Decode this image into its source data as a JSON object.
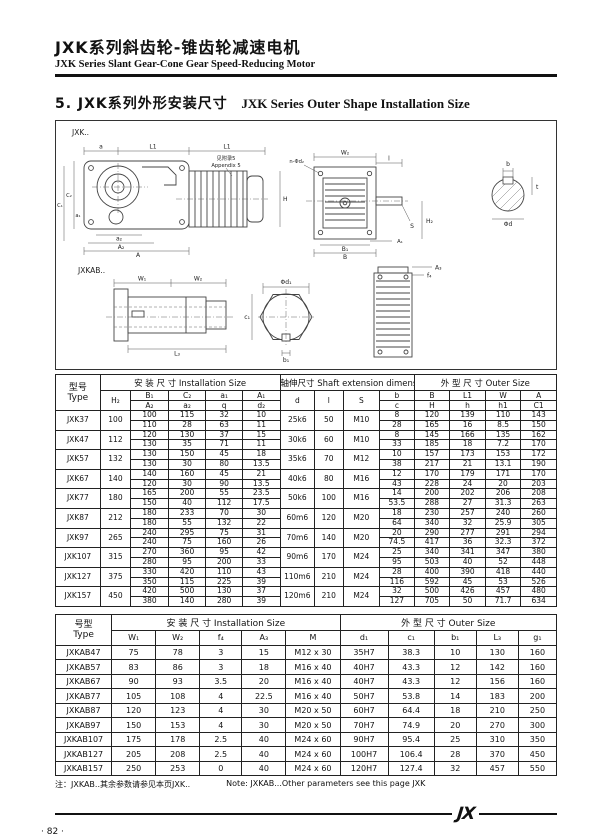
{
  "header": {
    "title_cn": "JXK系列斜齿轮-锥齿轮减速电机",
    "title_en": "JXK Series Slant Gear-Cone Gear Speed-Reducing Motor"
  },
  "section": {
    "title_cn": "5. JXK系列外形安装尺寸",
    "title_en": "JXK Series Outer Shape Installation Size"
  },
  "drawing": {
    "label_jxk": "JXK..",
    "label_jxkab": "JXKAB..",
    "appendix_cn": "见附录5",
    "appendix_en": "Appendix 5",
    "dims": [
      "a",
      "L1",
      "L1",
      "C₁",
      "C₂",
      "a₂",
      "A₂",
      "A",
      "a₁",
      "H",
      "W₂",
      "l",
      "S",
      "n-Φd₂",
      "B₁",
      "B",
      "A₁",
      "b",
      "t",
      "Φd",
      "W₁",
      "W₂",
      "L₃",
      "Φd₁",
      "c₁",
      "b₁",
      "A₃",
      "f₄",
      "H₂"
    ]
  },
  "table1": {
    "type_header": [
      "型号",
      "Type"
    ],
    "groups": [
      {
        "label": "安 装 尺 寸 Installation Size",
        "span": 5
      },
      {
        "label": "轴伸尺寸 Shaft extension dimension",
        "span": 4
      },
      {
        "label": "外 型 尺 寸 Outer Size",
        "span": 4
      }
    ],
    "sub_headers": [
      "H₂",
      [
        "B₁",
        "A₂"
      ],
      [
        "C₂",
        "a₂"
      ],
      [
        "a₁",
        "q"
      ],
      [
        "A₁",
        "d₂"
      ],
      "d",
      "l",
      "S",
      [
        "b",
        "c"
      ],
      [
        "B",
        "H"
      ],
      [
        "L1",
        "h"
      ],
      [
        "W",
        "h1"
      ],
      [
        "A",
        "C1"
      ]
    ],
    "rows": [
      {
        "type": "JXK37",
        "cells": [
          "100",
          [
            "100",
            "110"
          ],
          [
            "115",
            "28"
          ],
          [
            "32",
            "63"
          ],
          [
            "10",
            "11"
          ],
          "25k6",
          "50",
          "M10",
          [
            "8",
            "28"
          ],
          [
            "120",
            "165"
          ],
          [
            "139",
            "16"
          ],
          [
            "110",
            "8.5"
          ],
          [
            "143",
            "150"
          ]
        ]
      },
      {
        "type": "JXK47",
        "cells": [
          "112",
          [
            "120",
            "130"
          ],
          [
            "130",
            "35"
          ],
          [
            "37",
            "71"
          ],
          [
            "15",
            "11"
          ],
          "30k6",
          "60",
          "M10",
          [
            "8",
            "33"
          ],
          [
            "145",
            "185"
          ],
          [
            "166",
            "18"
          ],
          [
            "135",
            "7.2"
          ],
          [
            "162",
            "170"
          ]
        ]
      },
      {
        "type": "JXK57",
        "cells": [
          "132",
          [
            "130",
            "130"
          ],
          [
            "150",
            "30"
          ],
          [
            "45",
            "80"
          ],
          [
            "18",
            "13.5"
          ],
          "35k6",
          "70",
          "M12",
          [
            "10",
            "38"
          ],
          [
            "157",
            "217"
          ],
          [
            "173",
            "21"
          ],
          [
            "153",
            "13.1"
          ],
          [
            "172",
            "190"
          ]
        ]
      },
      {
        "type": "JXK67",
        "cells": [
          "140",
          [
            "140",
            "120"
          ],
          [
            "160",
            "30"
          ],
          [
            "45",
            "90"
          ],
          [
            "21",
            "13.5"
          ],
          "40k6",
          "80",
          "M16",
          [
            "12",
            "43"
          ],
          [
            "170",
            "228"
          ],
          [
            "179",
            "24"
          ],
          [
            "171",
            "20"
          ],
          [
            "170",
            "203"
          ]
        ]
      },
      {
        "type": "JXK77",
        "cells": [
          "180",
          [
            "165",
            "150"
          ],
          [
            "200",
            "40"
          ],
          [
            "55",
            "112"
          ],
          [
            "23.5",
            "17.5"
          ],
          "50k6",
          "100",
          "M16",
          [
            "14",
            "53.5"
          ],
          [
            "200",
            "288"
          ],
          [
            "202",
            "27"
          ],
          [
            "206",
            "31.3"
          ],
          [
            "208",
            "263"
          ]
        ]
      },
      {
        "type": "JXK87",
        "cells": [
          "212",
          [
            "180",
            "180"
          ],
          [
            "233",
            "55"
          ],
          [
            "70",
            "132"
          ],
          [
            "30",
            "22"
          ],
          "60m6",
          "120",
          "M20",
          [
            "18",
            "64"
          ],
          [
            "230",
            "340"
          ],
          [
            "257",
            "32"
          ],
          [
            "240",
            "25.9"
          ],
          [
            "260",
            "305"
          ]
        ]
      },
      {
        "type": "JXK97",
        "cells": [
          "265",
          [
            "240",
            "240"
          ],
          [
            "295",
            "75"
          ],
          [
            "75",
            "160"
          ],
          [
            "31",
            "26"
          ],
          "70m6",
          "140",
          "M20",
          [
            "20",
            "74.5"
          ],
          [
            "290",
            "417"
          ],
          [
            "277",
            "36"
          ],
          [
            "291",
            "32.3"
          ],
          [
            "294",
            "372"
          ]
        ]
      },
      {
        "type": "JXK107",
        "cells": [
          "315",
          [
            "270",
            "280"
          ],
          [
            "360",
            "95"
          ],
          [
            "95",
            "200"
          ],
          [
            "42",
            "33"
          ],
          "90m6",
          "170",
          "M24",
          [
            "25",
            "95"
          ],
          [
            "340",
            "503"
          ],
          [
            "341",
            "40"
          ],
          [
            "347",
            "52"
          ],
          [
            "380",
            "448"
          ]
        ]
      },
      {
        "type": "JXK127",
        "cells": [
          "375",
          [
            "330",
            "350"
          ],
          [
            "420",
            "115"
          ],
          [
            "110",
            "225"
          ],
          [
            "43",
            "39"
          ],
          "110m6",
          "210",
          "M24",
          [
            "28",
            "116"
          ],
          [
            "400",
            "592"
          ],
          [
            "390",
            "45"
          ],
          [
            "418",
            "53"
          ],
          [
            "440",
            "526"
          ]
        ]
      },
      {
        "type": "JXK157",
        "cells": [
          "450",
          [
            "420",
            "380"
          ],
          [
            "500",
            "140"
          ],
          [
            "130",
            "280"
          ],
          [
            "37",
            "39"
          ],
          "120m6",
          "210",
          "M24",
          [
            "32",
            "127"
          ],
          [
            "500",
            "705"
          ],
          [
            "426",
            "50"
          ],
          [
            "457",
            "71.7"
          ],
          [
            "480",
            "634"
          ]
        ]
      }
    ]
  },
  "table2": {
    "type_header": [
      "号型",
      "Type"
    ],
    "groups": [
      {
        "label": "安  装  尺  寸  Installation Size",
        "span": 5
      },
      {
        "label": "外  型  尺  寸  Outer Size",
        "span": 5
      }
    ],
    "sub_headers": [
      "W₁",
      "W₂",
      "f₄",
      "A₃",
      "M",
      "d₁",
      "c₁",
      "b₁",
      "L₃",
      "g₁"
    ],
    "rows": [
      {
        "type": "JXKAB47",
        "cells": [
          "75",
          "78",
          "3",
          "15",
          "M12 x 30",
          "35H7",
          "38.3",
          "10",
          "130",
          "160"
        ]
      },
      {
        "type": "JXKAB57",
        "cells": [
          "83",
          "86",
          "3",
          "18",
          "M16 x 40",
          "40H7",
          "43.3",
          "12",
          "142",
          "160"
        ]
      },
      {
        "type": "JXKAB67",
        "cells": [
          "90",
          "93",
          "3.5",
          "20",
          "M16 x 40",
          "40H7",
          "43.3",
          "12",
          "156",
          "160"
        ]
      },
      {
        "type": "JXKAB77",
        "cells": [
          "105",
          "108",
          "4",
          "22.5",
          "M16 x 40",
          "50H7",
          "53.8",
          "14",
          "183",
          "200"
        ]
      },
      {
        "type": "JXKAB87",
        "cells": [
          "120",
          "123",
          "4",
          "30",
          "M20 x 50",
          "60H7",
          "64.4",
          "18",
          "210",
          "250"
        ]
      },
      {
        "type": "JXKAB97",
        "cells": [
          "150",
          "153",
          "4",
          "30",
          "M20 x 50",
          "70H7",
          "74.9",
          "20",
          "270",
          "300"
        ]
      },
      {
        "type": "JXKAB107",
        "cells": [
          "175",
          "178",
          "2.5",
          "40",
          "M24 x 60",
          "90H7",
          "95.4",
          "25",
          "310",
          "350"
        ]
      },
      {
        "type": "JXKAB127",
        "cells": [
          "205",
          "208",
          "2.5",
          "40",
          "M24 x 60",
          "100H7",
          "106.4",
          "28",
          "370",
          "450"
        ]
      },
      {
        "type": "JXKAB157",
        "cells": [
          "250",
          "253",
          "0",
          "40",
          "M24 x 60",
          "120H7",
          "127.4",
          "32",
          "457",
          "550"
        ]
      }
    ]
  },
  "note": {
    "cn": "注：JXKAB..其余参数请参见本页JXK..",
    "en": "Note: JXKAB...Other parameters see this page JXK"
  },
  "footer": {
    "page": "· 82 ·",
    "logo": "JX"
  }
}
